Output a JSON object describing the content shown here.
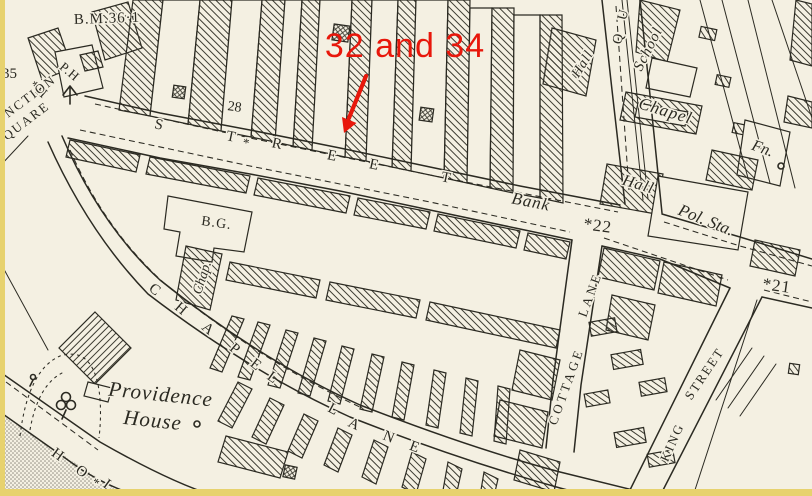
{
  "annotation": {
    "text": "32 and 34",
    "color": "#e8170b",
    "arrow": {
      "from_x": 366,
      "from_y": 76,
      "to_x": 344,
      "to_y": 131
    }
  },
  "map": {
    "colors": {
      "paper": "#f4f0e2",
      "ink": "#2b2a22",
      "hatch_line": "#3c3b31",
      "red_annotation": "#e8170b",
      "scan_border_yellow": "#e7d26e",
      "stipple_gray": "#8f8b80"
    },
    "labels": [
      {
        "id": "red-annotation-text",
        "text": "32 and 34",
        "x": 405,
        "y": 57,
        "size": 34,
        "rot": 0,
        "font": "sans",
        "ls": 1
      },
      {
        "id": "benchmark-value",
        "text": "B.M.36·1",
        "x": 74,
        "y": 24,
        "size": 15,
        "rot": -2,
        "font": "serif",
        "anchor": "start",
        "ls": 1
      },
      {
        "id": "number-35",
        "text": "35",
        "x": 2,
        "y": 78,
        "size": 15,
        "rot": 0,
        "font": "serif",
        "anchor": "start",
        "ls": 0
      },
      {
        "id": "ph-label",
        "text": "P.H",
        "x": 67,
        "y": 75,
        "size": 13,
        "rot": 40,
        "font": "serif",
        "ls": 1
      },
      {
        "id": "star-h-label",
        "text": "*H",
        "x": 36,
        "y": 93,
        "size": 14,
        "rot": 40,
        "font": "serif",
        "ls": 1
      },
      {
        "id": "junction-label",
        "text": "UNCTION",
        "x": 28,
        "y": 103,
        "size": 13,
        "rot": -37,
        "font": "serif",
        "ls": 2
      },
      {
        "id": "square-label",
        "text": "SQUARE",
        "x": 25,
        "y": 127,
        "size": 13,
        "rot": -37,
        "font": "serif",
        "ls": 2
      },
      {
        "id": "number-28",
        "text": "28",
        "x": 234,
        "y": 111,
        "size": 14,
        "rot": 8,
        "font": "serif",
        "ls": 0
      },
      {
        "id": "street-letter-1",
        "text": "S",
        "x": 158,
        "y": 129,
        "size": 15,
        "rot": 12,
        "font": "serif",
        "ls": 0
      },
      {
        "id": "street-letter-2",
        "text": "T",
        "x": 230,
        "y": 141,
        "size": 15,
        "rot": 12,
        "font": "serif",
        "ls": 0
      },
      {
        "id": "street-star",
        "text": "*",
        "x": 245,
        "y": 147,
        "size": 13,
        "rot": 12,
        "font": "serif",
        "ls": 0
      },
      {
        "id": "street-letter-3",
        "text": "R",
        "x": 276,
        "y": 148,
        "size": 15,
        "rot": 12,
        "font": "serif",
        "ls": 0
      },
      {
        "id": "street-letter-4",
        "text": "E",
        "x": 331,
        "y": 160,
        "size": 15,
        "rot": 12,
        "font": "serif",
        "ls": 0
      },
      {
        "id": "street-letter-5",
        "text": "E",
        "x": 373,
        "y": 169,
        "size": 15,
        "rot": 12,
        "font": "serif",
        "ls": 0
      },
      {
        "id": "street-letter-6",
        "text": "T",
        "x": 445,
        "y": 182,
        "size": 15,
        "rot": 12,
        "font": "serif",
        "ls": 0
      },
      {
        "id": "bank-label",
        "text": "Bank",
        "x": 530,
        "y": 207,
        "size": 17,
        "rot": 11,
        "font": "italic",
        "ls": 1
      },
      {
        "id": "number-22",
        "text": "*22",
        "x": 597,
        "y": 231,
        "size": 17,
        "rot": 8,
        "font": "serif",
        "ls": 1
      },
      {
        "id": "number-21",
        "text": "*21",
        "x": 776,
        "y": 291,
        "size": 17,
        "rot": 8,
        "font": "serif",
        "ls": 1
      },
      {
        "id": "hall-top-label",
        "text": "Hall",
        "x": 586,
        "y": 66,
        "size": 14,
        "rot": -58,
        "font": "italic",
        "ls": 1
      },
      {
        "id": "queen-street-letter-q",
        "text": "Q",
        "x": 622,
        "y": 40,
        "size": 14,
        "rot": -75,
        "font": "serif",
        "ls": 0
      },
      {
        "id": "queen-street-letter-u",
        "text": "U",
        "x": 627,
        "y": 16,
        "size": 14,
        "rot": -75,
        "font": "serif",
        "ls": 0
      },
      {
        "id": "school-label",
        "text": "School",
        "x": 652,
        "y": 51,
        "size": 15,
        "rot": -63,
        "font": "italic",
        "ls": 1
      },
      {
        "id": "chapel-building-label",
        "text": "Chapel",
        "x": 664,
        "y": 116,
        "size": 17,
        "rot": 17,
        "font": "italic",
        "ls": 1
      },
      {
        "id": "fountain-label",
        "text": "Fn.",
        "x": 761,
        "y": 153,
        "size": 16,
        "rot": 20,
        "font": "italic",
        "ls": 0
      },
      {
        "id": "hall-right-label",
        "text": "Hall",
        "x": 637,
        "y": 189,
        "size": 16,
        "rot": 17,
        "font": "italic",
        "ls": 1
      },
      {
        "id": "police-station-label",
        "text": "Pol. Sta.",
        "x": 704,
        "y": 225,
        "size": 17,
        "rot": 22,
        "font": "italic",
        "ls": 0
      },
      {
        "id": "bg-label",
        "text": "B.G.",
        "x": 216,
        "y": 227,
        "size": 14,
        "rot": 8,
        "font": "serif",
        "ls": 1
      },
      {
        "id": "chap-label",
        "text": "Chap.",
        "x": 206,
        "y": 279,
        "size": 14,
        "rot": -72,
        "font": "italic",
        "ls": 0
      },
      {
        "id": "chapel-lane-letter-c",
        "text": "C",
        "x": 152,
        "y": 293,
        "size": 15,
        "rot": 38,
        "font": "serif",
        "ls": 0
      },
      {
        "id": "chapel-lane-letter-h",
        "text": "H",
        "x": 178,
        "y": 312,
        "size": 15,
        "rot": 40,
        "font": "serif",
        "ls": 0
      },
      {
        "id": "chapel-lane-letter-a",
        "text": "A",
        "x": 205,
        "y": 332,
        "size": 15,
        "rot": 40,
        "font": "serif",
        "ls": 0
      },
      {
        "id": "chapel-lane-letter-p",
        "text": "P",
        "x": 232,
        "y": 352,
        "size": 15,
        "rot": 40,
        "font": "serif",
        "ls": 0
      },
      {
        "id": "chapel-lane-letter-e",
        "text": "E",
        "x": 253,
        "y": 368,
        "size": 15,
        "rot": 38,
        "font": "serif",
        "ls": 0
      },
      {
        "id": "chapel-lane-letter-l",
        "text": "L",
        "x": 270,
        "y": 381,
        "size": 15,
        "rot": 35,
        "font": "serif",
        "ls": 0
      },
      {
        "id": "lane-letter-l",
        "text": "L",
        "x": 331,
        "y": 413,
        "size": 15,
        "rot": 28,
        "font": "serif",
        "ls": 0
      },
      {
        "id": "lane-letter-a",
        "text": "A",
        "x": 352,
        "y": 428,
        "size": 15,
        "rot": 25,
        "font": "serif",
        "ls": 0
      },
      {
        "id": "lane-letter-n",
        "text": "N",
        "x": 387,
        "y": 441,
        "size": 15,
        "rot": 22,
        "font": "serif",
        "ls": 0
      },
      {
        "id": "lane-letter-e",
        "text": "E",
        "x": 413,
        "y": 451,
        "size": 15,
        "rot": 20,
        "font": "serif",
        "ls": 0
      },
      {
        "id": "providence-label",
        "text": "Providence",
        "x": 160,
        "y": 401,
        "size": 21,
        "rot": 6,
        "font": "italic",
        "ls": 1
      },
      {
        "id": "house-label",
        "text": "House",
        "x": 152,
        "y": 427,
        "size": 21,
        "rot": 6,
        "font": "italic",
        "ls": 1
      },
      {
        "id": "hol-letter-h",
        "text": "H",
        "x": 55,
        "y": 458,
        "size": 15,
        "rot": 36,
        "font": "serif",
        "ls": 0
      },
      {
        "id": "hol-letter-o",
        "text": "O",
        "x": 79,
        "y": 475,
        "size": 15,
        "rot": 36,
        "font": "serif",
        "ls": 0
      },
      {
        "id": "hol-star",
        "text": "*",
        "x": 93,
        "y": 486,
        "size": 13,
        "rot": 36,
        "font": "serif",
        "ls": 0
      },
      {
        "id": "hol-letter-l",
        "text": "L",
        "x": 106,
        "y": 489,
        "size": 15,
        "rot": 36,
        "font": "serif",
        "ls": 0
      },
      {
        "id": "cottage-lane-word-cottage",
        "text": "COTTAGE",
        "x": 570,
        "y": 388,
        "size": 13,
        "rot": -70,
        "font": "serif",
        "ls": 3
      },
      {
        "id": "cottage-lane-word-lane",
        "text": "LANE",
        "x": 594,
        "y": 296,
        "size": 13,
        "rot": -70,
        "font": "serif",
        "ls": 3
      },
      {
        "id": "king-street-word-king",
        "text": "KING",
        "x": 676,
        "y": 444,
        "size": 13,
        "rot": -66,
        "font": "serif",
        "ls": 2
      },
      {
        "id": "king-street-word-street",
        "text": "STREET",
        "x": 708,
        "y": 376,
        "size": 13,
        "rot": -56,
        "font": "serif",
        "ls": 2
      }
    ]
  }
}
